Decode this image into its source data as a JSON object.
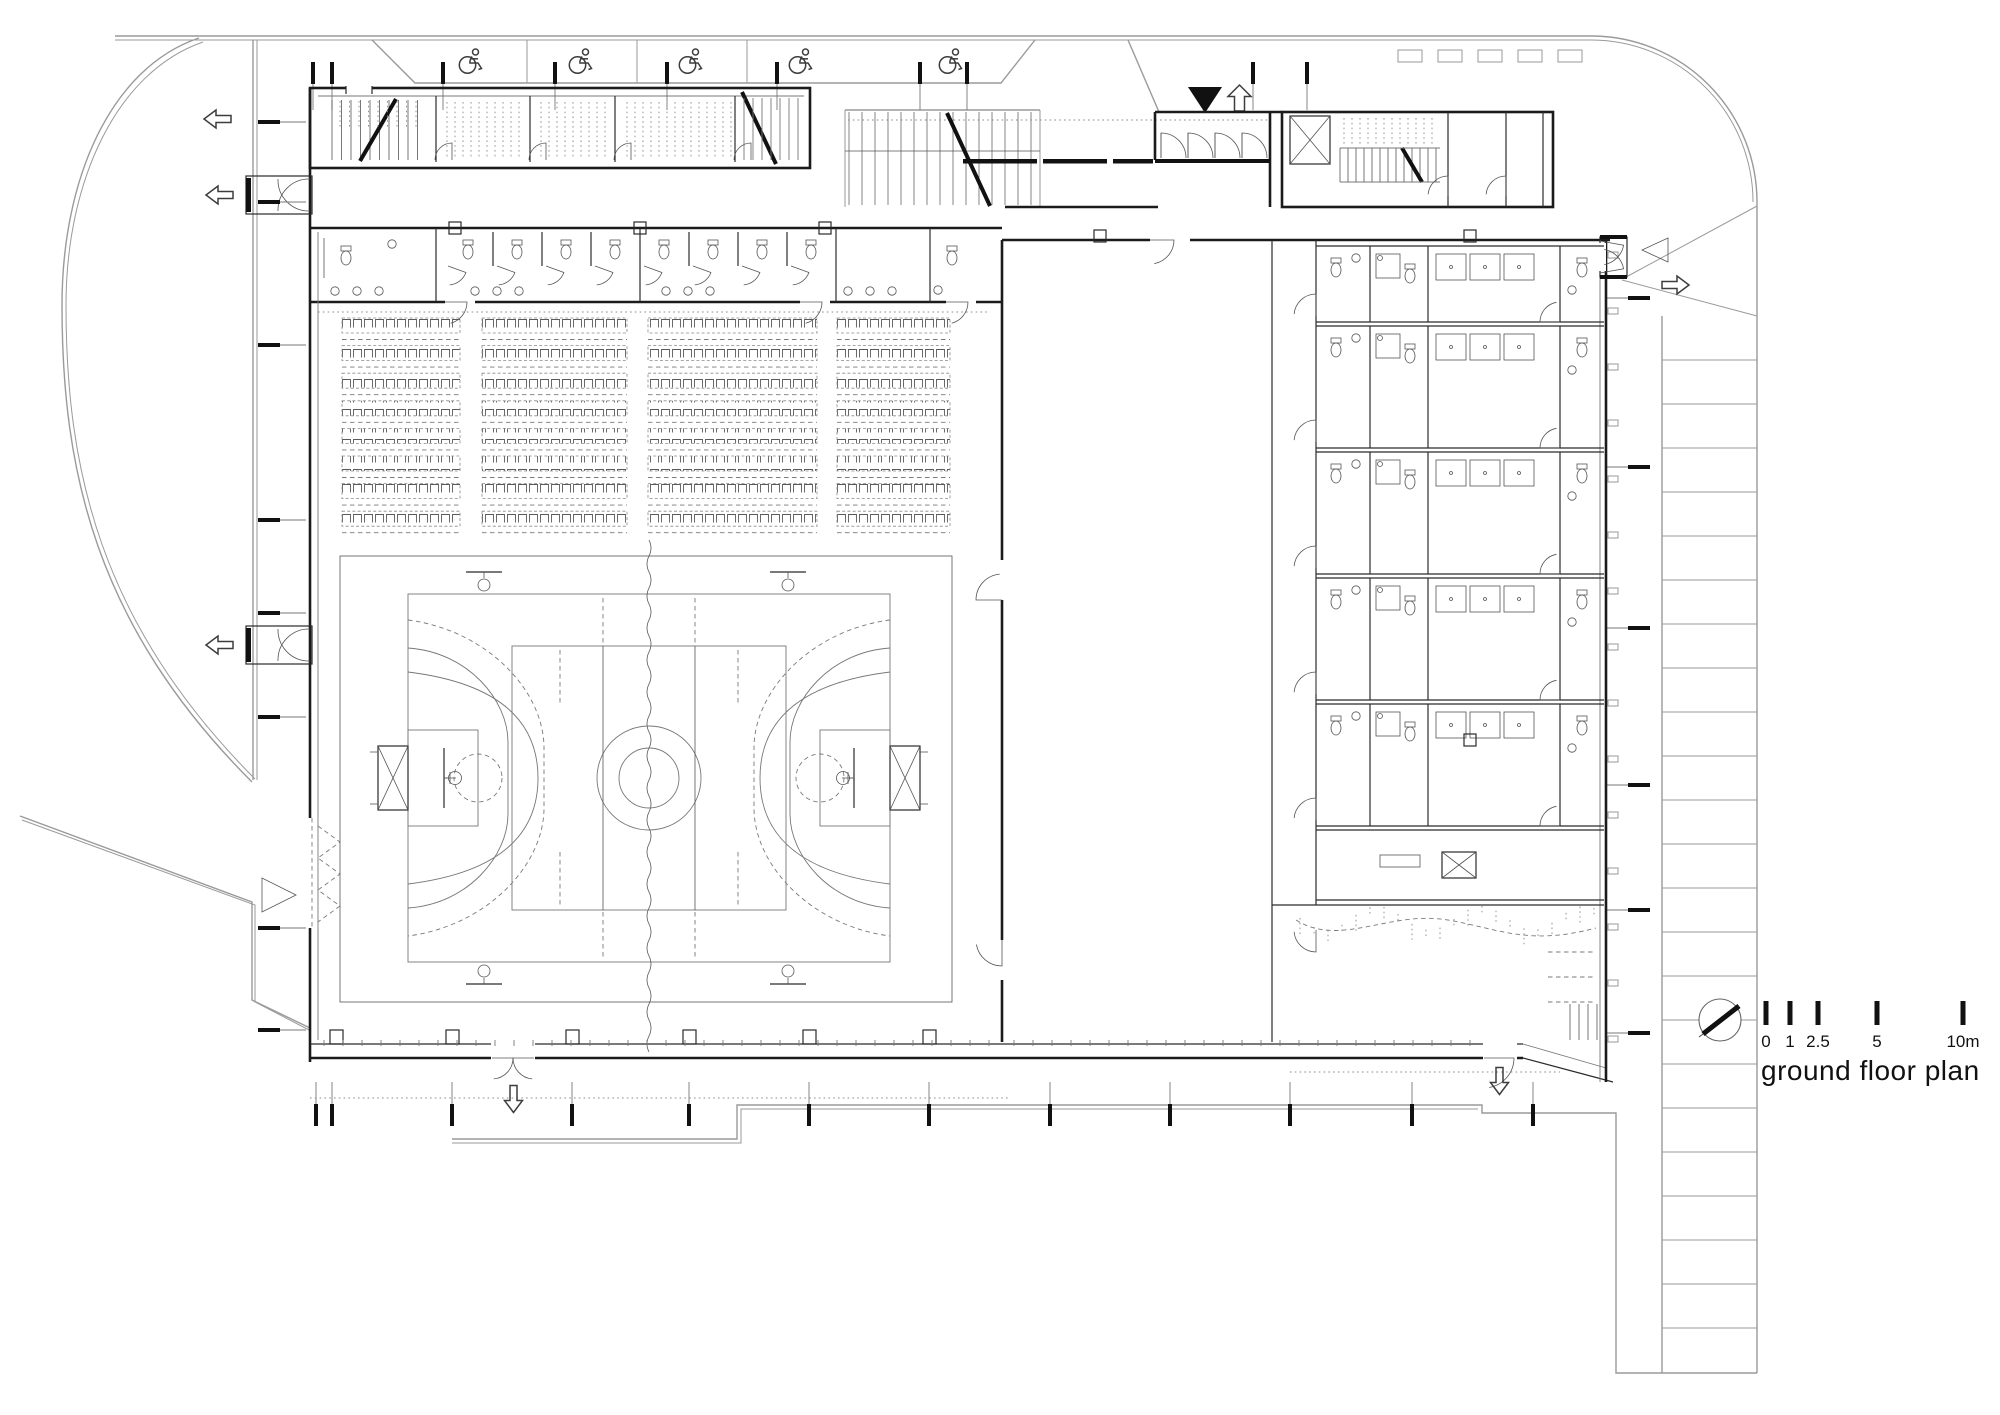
{
  "document": {
    "kind": "architectural ground floor plan",
    "paper_color": "#ffffff"
  },
  "title": {
    "label": "ground floor plan"
  },
  "scalebar": {
    "ticks": [
      {
        "label": "0"
      },
      {
        "label": "1"
      },
      {
        "label": "2.5"
      },
      {
        "label": "5"
      },
      {
        "label": "10m"
      }
    ]
  },
  "colors": {
    "walls": "#1b1b1b",
    "site_lines": "#9a9a9a",
    "fixtures": "#3d3d3d",
    "dashed": "#7a7a7a",
    "solid_black": "#111111",
    "paper": "#ffffff"
  },
  "icons": [
    "north-arrow-icon",
    "accessible-parking-icon",
    "entrance-filled-triangle-icon",
    "entrance-up-arrow-icon",
    "exit-left-arrow-icon",
    "exit-down-arrow-icon",
    "exit-right-arrow-icon",
    "direction-triangle-icon"
  ],
  "plan_features": {
    "accessible_parking_bays": 5,
    "bleacher_rows": 8,
    "bleacher_blocks_per_row": 4,
    "sports_court": "multi-use court (handball / basketball / volleyball) with centre curtain divider",
    "locker_suite_rows": 5,
    "toilet_stall_groups": 2,
    "exterior_side_steps": true,
    "bike_racks": 5
  }
}
